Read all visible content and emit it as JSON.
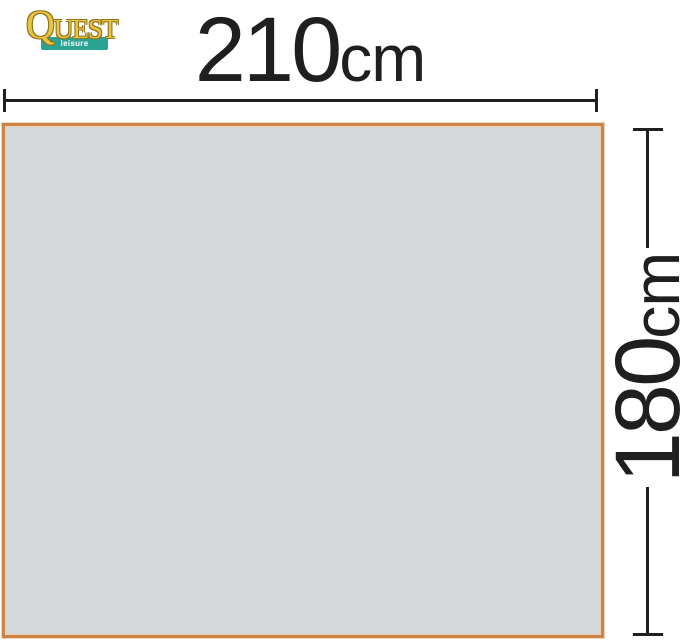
{
  "logo": {
    "brand_initial": "Q",
    "brand_rest": "UEST",
    "tagline": "leisure products"
  },
  "dimensions": {
    "width": {
      "value": "210",
      "unit": "cm"
    },
    "height": {
      "value": "180",
      "unit": "cm"
    }
  },
  "shape": {
    "description": "groundsheet footprint rectangle"
  },
  "colors": {
    "line_color": "#1f1f1f",
    "shape_fill": "#d5d7d8",
    "shape_border": "#cd8449",
    "logo_gold": "#e9c43f",
    "logo_gold_outline": "#8f731d",
    "logo_teal": "#29a392",
    "logo_tagline_text": "#ffffff"
  }
}
